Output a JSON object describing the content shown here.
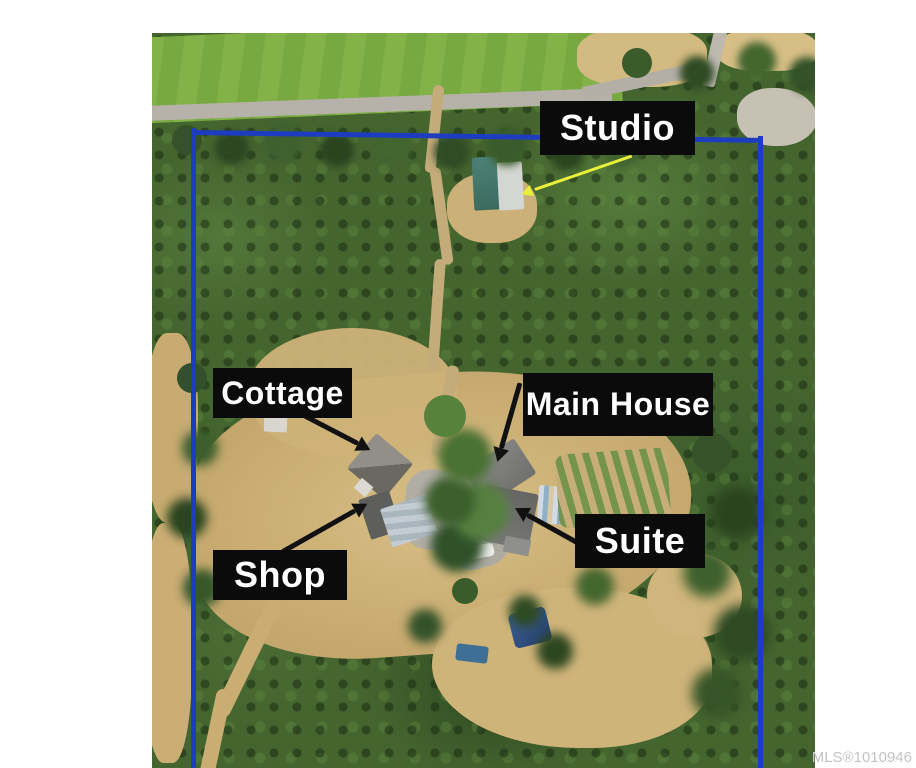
{
  "photo": {
    "type": "aerial-drone-photo-of-forested-acreage-with-buildings"
  },
  "annotations": {
    "studio": "Studio",
    "cottage": "Cottage",
    "main_house": "Main House",
    "shop": "Shop",
    "suite": "Suite"
  },
  "watermark": "MLS®1010946",
  "colors": {
    "boundary": "#1e3cc0",
    "label_bg": "#0b0b0b",
    "label_fg": "#ffffff",
    "arrow_black": "#111111",
    "arrow_yellow": "#e9ef3a"
  }
}
